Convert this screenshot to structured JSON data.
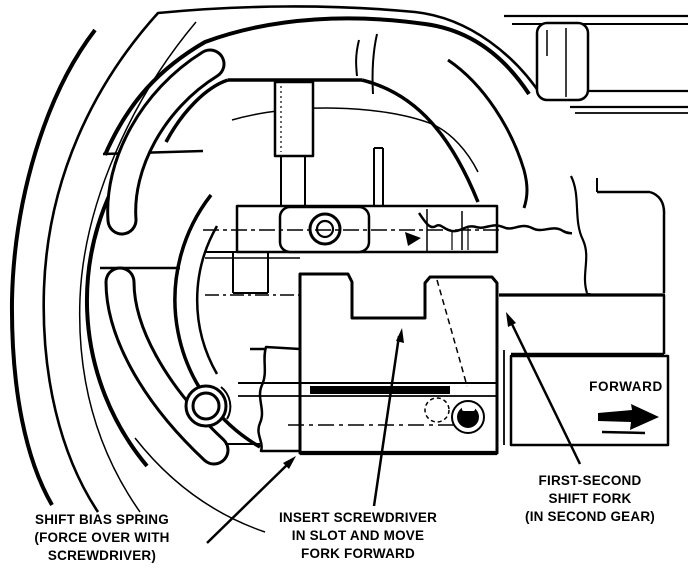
{
  "figure": {
    "kind": "technical-line-diagram",
    "subject": "Transmission cutaway showing first-second shift fork positioning",
    "ink_color": "#000000",
    "paper_color": "#ffffff",
    "labels": {
      "shift_bias_spring": [
        "SHIFT BIAS SPRING",
        "(FORCE OVER WITH",
        "SCREWDRIVER)"
      ],
      "insert_screwdriver": [
        "INSERT SCREWDRIVER",
        "IN SLOT AND MOVE",
        "FORK FORWARD"
      ],
      "first_second_fork": [
        "FIRST-SECOND",
        "SHIFT FORK",
        "(IN SECOND GEAR)"
      ],
      "forward": "FORWARD"
    },
    "icons": {
      "forward_arrow": "right-filled-arrow",
      "leader_arrows": "filled-triangle-leader"
    }
  }
}
